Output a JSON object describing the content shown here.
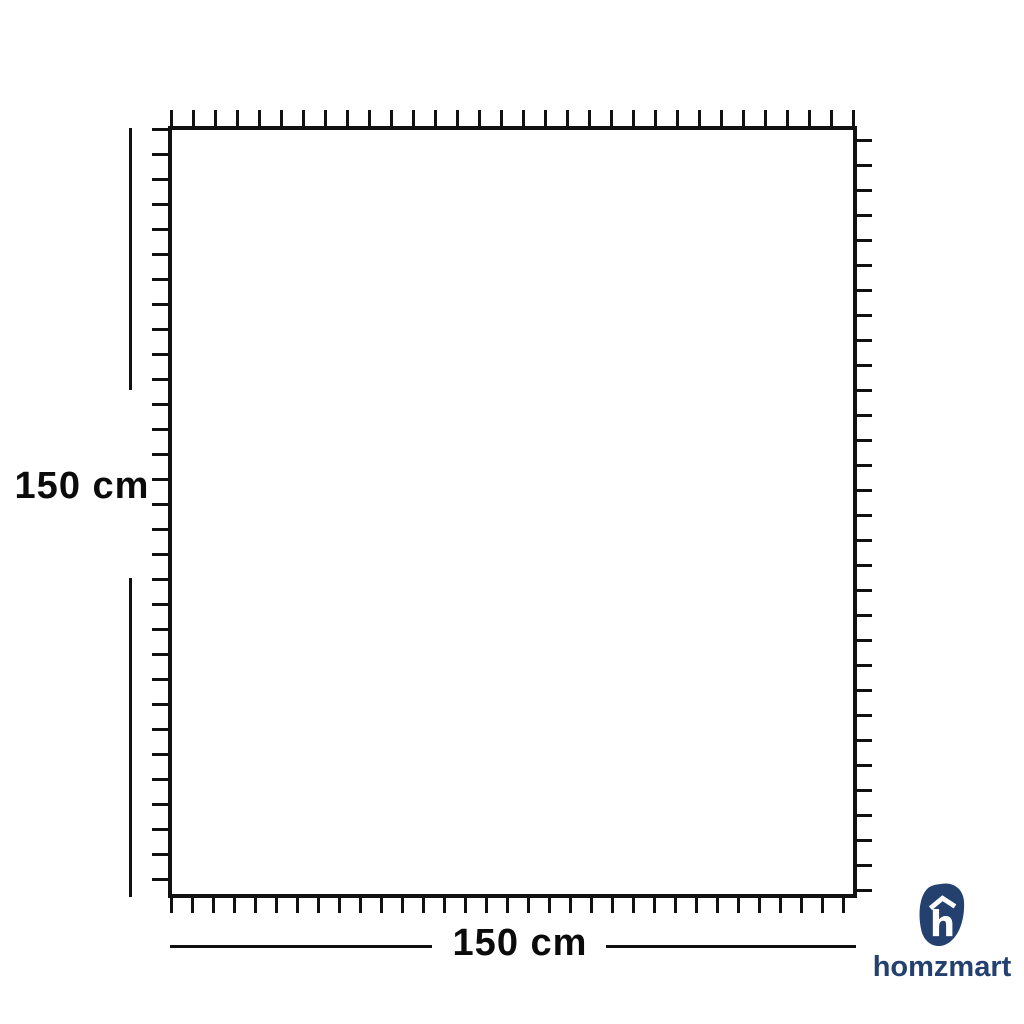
{
  "diagram": {
    "height_label": "150 cm",
    "width_label": "150 cm"
  },
  "brand": {
    "wordmark": "homzmart",
    "monogram_letter": "h",
    "logo_color": "#24406e"
  },
  "colors": {
    "diagram_lines": "#111111",
    "background": "#ffffff"
  }
}
